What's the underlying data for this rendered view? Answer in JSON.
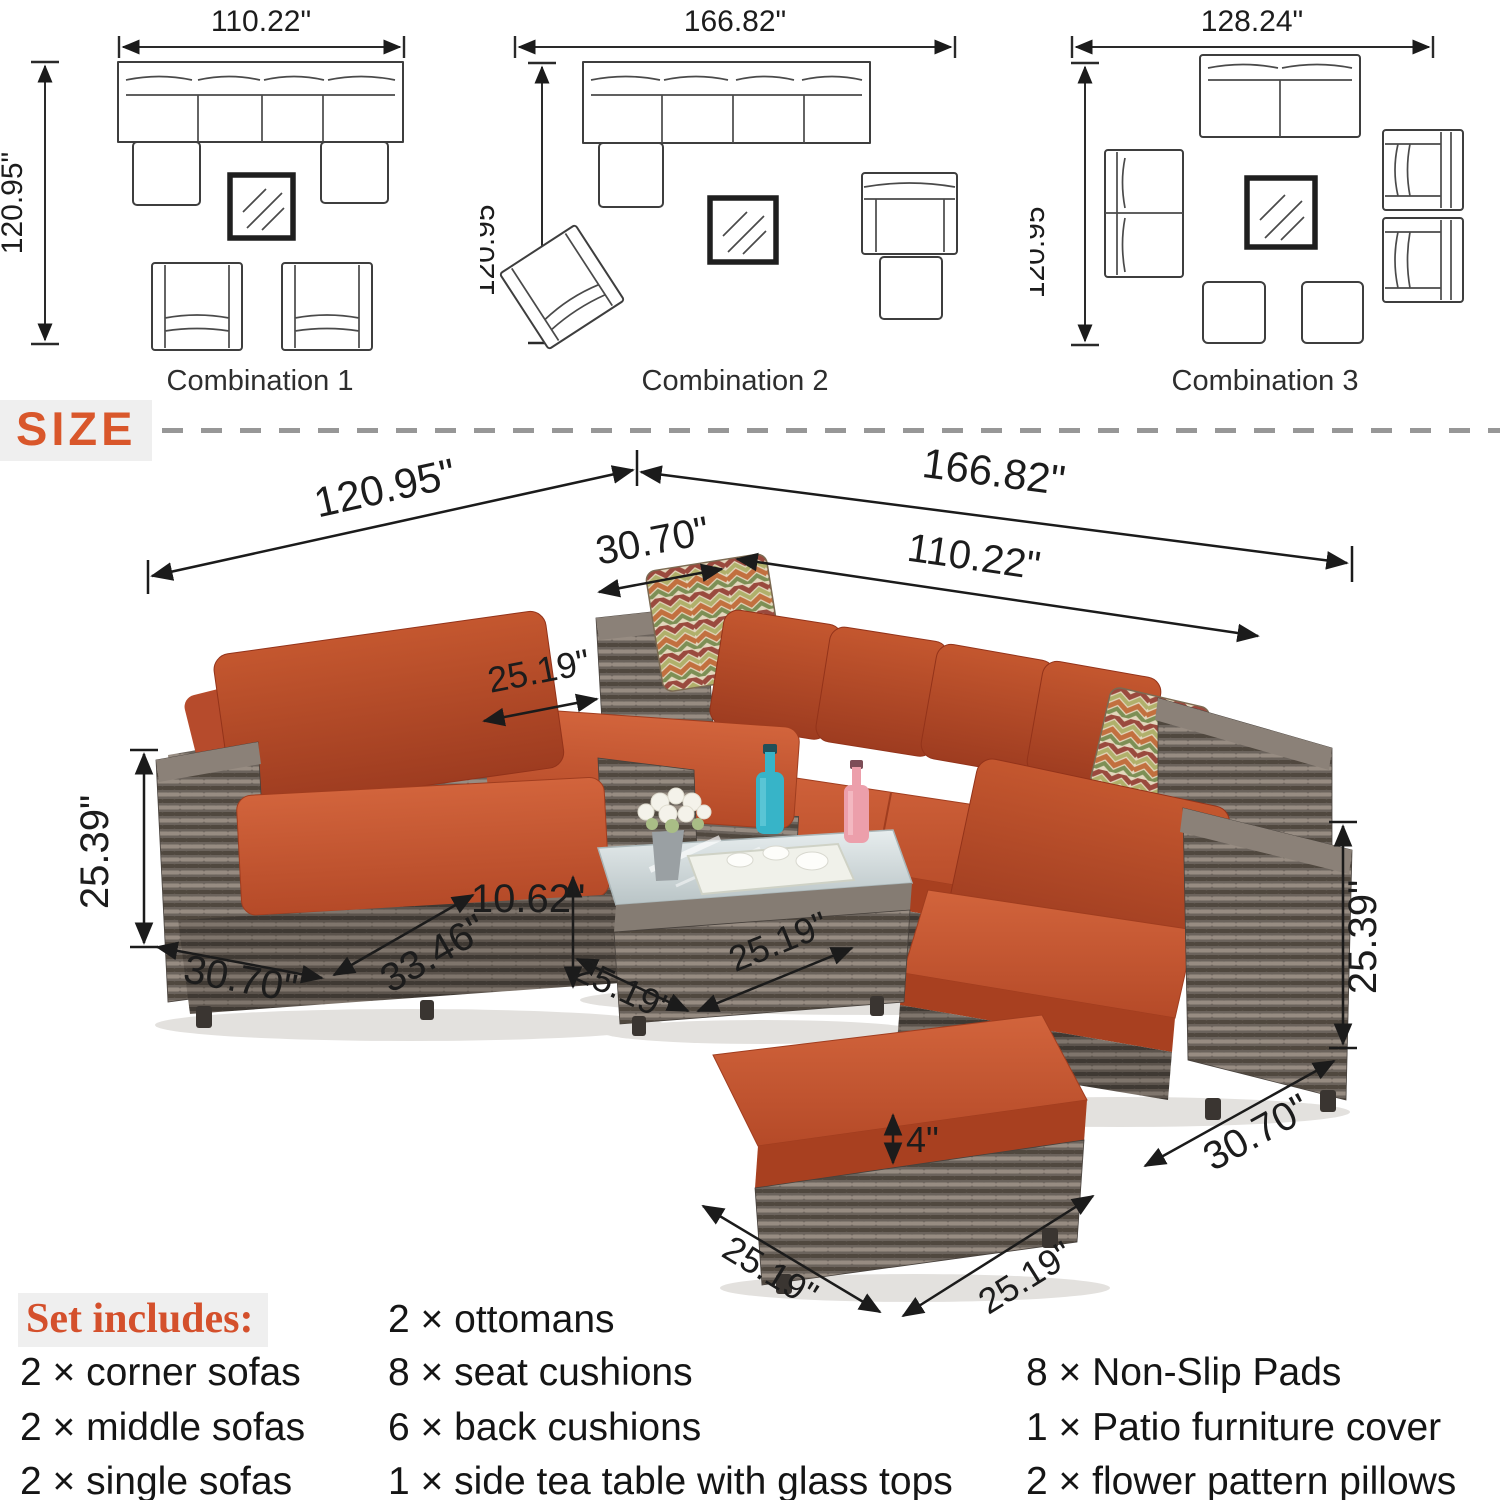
{
  "combinations": [
    {
      "label": "Combination 1",
      "width_label": "110.22\"",
      "height_label": "120.95\""
    },
    {
      "label": "Combination 2",
      "width_label": "166.82\"",
      "height_label": "120.95\""
    },
    {
      "label": "Combination 3",
      "width_label": "128.24\"",
      "height_label": "120.95\""
    }
  ],
  "size_section": {
    "title": "SIZE"
  },
  "hero_dims": {
    "overall_left": "120.95\"",
    "overall_right": "166.82\"",
    "corner_width": "30.70\"",
    "sofa_run": "110.22\"",
    "left_ottoman_depth": "25.19\"",
    "left_chair_height": "25.39\"",
    "left_chair_width": "30.70\"",
    "left_chair_depth": "33.46\"",
    "table_height": "10.62\"",
    "table_depth": "25.19\"",
    "table_width": "25.19\"",
    "cushion_thickness": "4\"",
    "front_ottoman_depth": "25.19\"",
    "front_ottoman_width": "25.19\"",
    "right_chair_height": "25.39\"",
    "right_chair_width": "30.70\""
  },
  "set_includes": {
    "title": "Set includes:",
    "column1": [
      "2 × corner sofas",
      "2 × middle sofas",
      "2 × single sofas"
    ],
    "column2": [
      "2 × ottomans",
      "8 × seat cushions",
      "6 × back cushions",
      "1 × side tea table with glass tops"
    ],
    "column3": [
      "8 × Non-Slip Pads",
      "1 × Patio furniture cover",
      "2 × flower pattern pillows"
    ]
  },
  "colors": {
    "accent_orange": "#d9572b",
    "cushion_orange": "#c35430",
    "cushion_shadow": "#a84020",
    "wicker_gray": "#6b635c",
    "dimension_line": "#1b1b1b",
    "divider_gray": "#979797",
    "highlight_bg": "#efefef"
  }
}
